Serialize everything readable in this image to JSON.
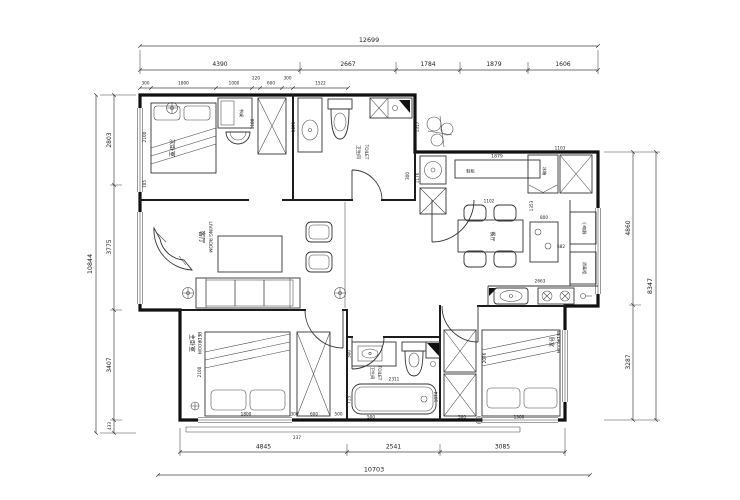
{
  "rooms": {
    "bedroom2": {
      "cn": "次卧室"
    },
    "toilet1": {
      "cn": "卫生间",
      "en": "TOILET"
    },
    "living": {
      "cn": "客厅",
      "en": "LIVING ROOM"
    },
    "dining": {
      "cn": "餐厅"
    },
    "master": {
      "cn": "主卧室",
      "en": "BEDROOM"
    },
    "toilet2": {
      "cn": "卫生间",
      "en": "TOILET"
    },
    "bedroom3": {
      "cn": "卧室",
      "en": "BEDROOM"
    }
  },
  "fixtures": {
    "fridge": "冰箱",
    "shoe_cabinet": "鞋柜",
    "desk": "书桌",
    "appliance1": "小电器",
    "appliance2": "消毒柜"
  },
  "dims": {
    "top_total": "12699",
    "top": [
      "4390",
      "2667",
      "1784",
      "1879",
      "1606"
    ],
    "top_inner": [
      "300",
      "1800",
      "1000",
      "220",
      "600",
      "300",
      "1522"
    ],
    "left_total": "10844",
    "left": [
      "2803",
      "3775",
      "3407",
      "433"
    ],
    "right_total": "8347",
    "right": [
      "4860",
      "3287"
    ],
    "bottom": [
      "4845",
      "2541",
      "3085"
    ],
    "bottom_total": "10703",
    "inner": {
      "bed2_w": "2100",
      "bed2_s": "705",
      "ward2": "1100",
      "sink1": "1091",
      "notch_a": "1317",
      "notch_b": "1176",
      "entry_a": "300",
      "shoe": "1879",
      "fridge_w": "1103",
      "hall": "1353",
      "table_w": "1102",
      "sideboard": "800",
      "counter_r": "682",
      "counter_b": "2663",
      "tub": "2311",
      "bath_a": "713",
      "bath_b": "500",
      "bath_c": "1074",
      "bath_d": "300",
      "mbed_l": "2100",
      "mbed_w": "1800",
      "mgap": "300",
      "mward": "600",
      "mside": "500",
      "bed3_l": "2076",
      "bed3_a": "500",
      "bed3_b": "1300",
      "rail": "237"
    }
  }
}
